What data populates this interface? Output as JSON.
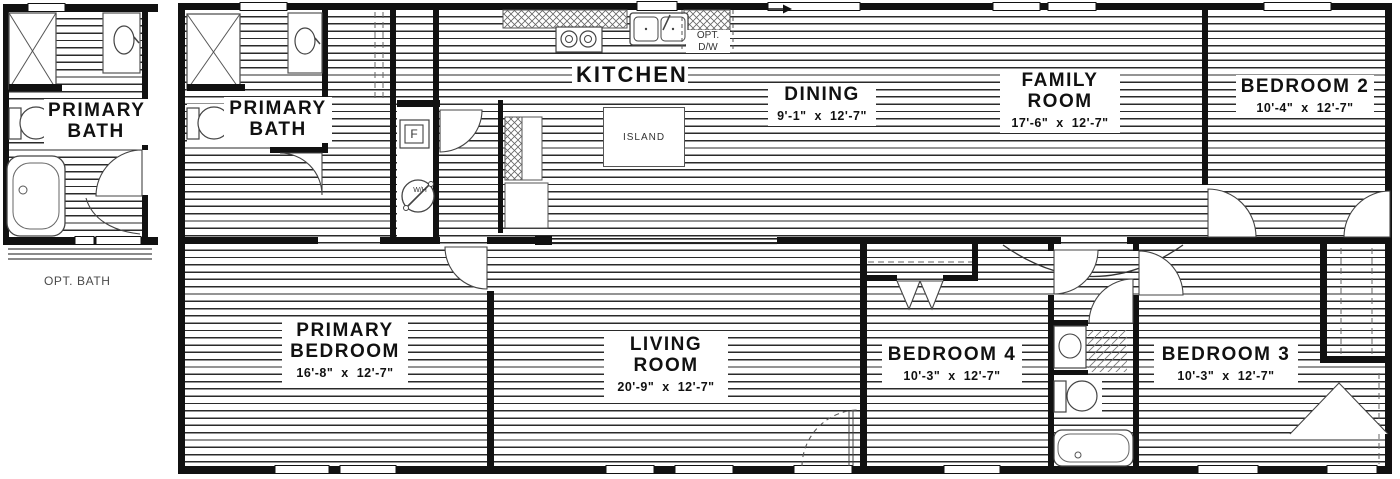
{
  "title": "Floor plan",
  "captions": {
    "opt_bath": "OPT. BATH"
  },
  "rooms": {
    "primary_bath_opt": {
      "line1": "PRIMARY",
      "line2": "BATH"
    },
    "primary_bath": {
      "line1": "PRIMARY",
      "line2": "BATH"
    },
    "kitchen": {
      "name": "KITCHEN"
    },
    "dining": {
      "name": "DINING",
      "dims": "9'-1\" x 12'-7\""
    },
    "family_room": {
      "line1": "FAMILY",
      "line2": "ROOM",
      "dims": "17'-6\" x 12'-7\""
    },
    "bedroom2": {
      "name": "BEDROOM 2",
      "dims": "10'-4\" x 12'-7\""
    },
    "primary_bedroom": {
      "line1": "PRIMARY",
      "line2": "BEDROOM",
      "dims": "16'-8\" x 12'-7\""
    },
    "living_room": {
      "line1": "LIVING",
      "line2": "ROOM",
      "dims": "20'-9\" x 12'-7\""
    },
    "bedroom4": {
      "name": "BEDROOM 4",
      "dims": "10'-3\" x 12'-7\""
    },
    "bedroom3": {
      "name": "BEDROOM 3",
      "dims": "10'-3\" x 12'-7\""
    }
  },
  "fixtures": {
    "island": "ISLAND",
    "opt_dw_line1": "OPT.",
    "opt_dw_line2": "D/W",
    "furnace": "F",
    "water_heater": "W/H"
  },
  "colors": {
    "wall": "#111111",
    "hatch_line": "#2a2a2a",
    "text": "#111111",
    "caption": "#4a4a4a"
  }
}
